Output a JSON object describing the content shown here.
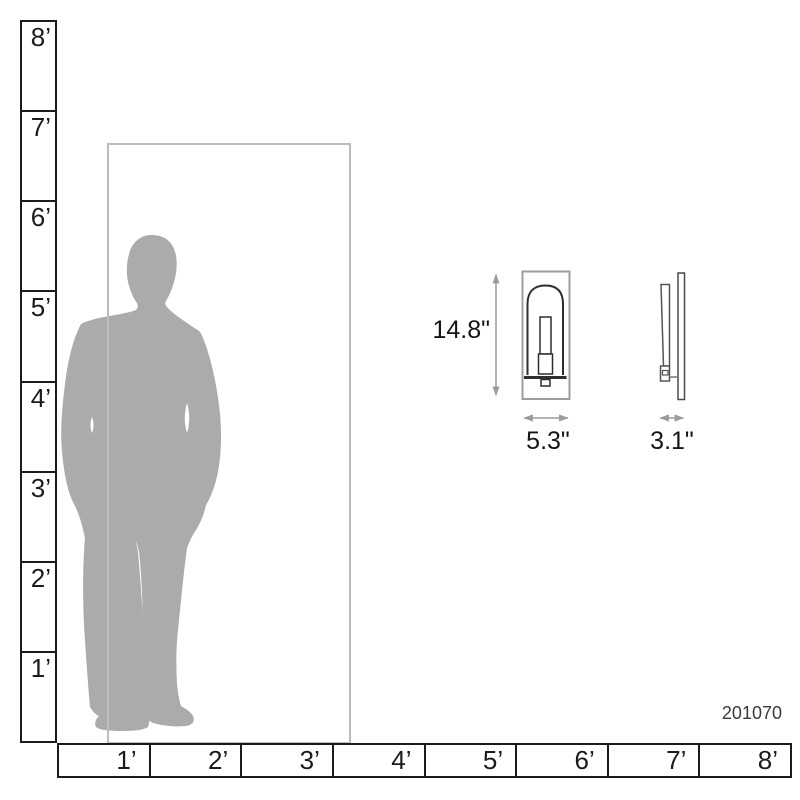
{
  "diagram": {
    "title": "product dimension scale diagram",
    "part_number": "201070",
    "front_view": {
      "height_label": "14.8\"",
      "width_label": "5.3\""
    },
    "side_view": {
      "depth_label": "3.1\""
    },
    "left_ruler": {
      "labels": [
        "8’",
        "7’",
        "6’",
        "5’",
        "4’",
        "3’",
        "2’",
        "1’"
      ]
    },
    "bottom_ruler": {
      "labels": [
        "1’",
        "2’",
        "3’",
        "4’",
        "5’",
        "6’",
        "7’",
        "8’"
      ]
    },
    "colors": {
      "silhouette_gray": "#ababab",
      "door_outline_gray": "#bcbcbc",
      "ruler_black": "#1b1b1b",
      "dimension_line_gray": "#9b9b9b",
      "drawing_dark": "#2e2e2e",
      "drawing_light": "#9e9e9e"
    }
  }
}
